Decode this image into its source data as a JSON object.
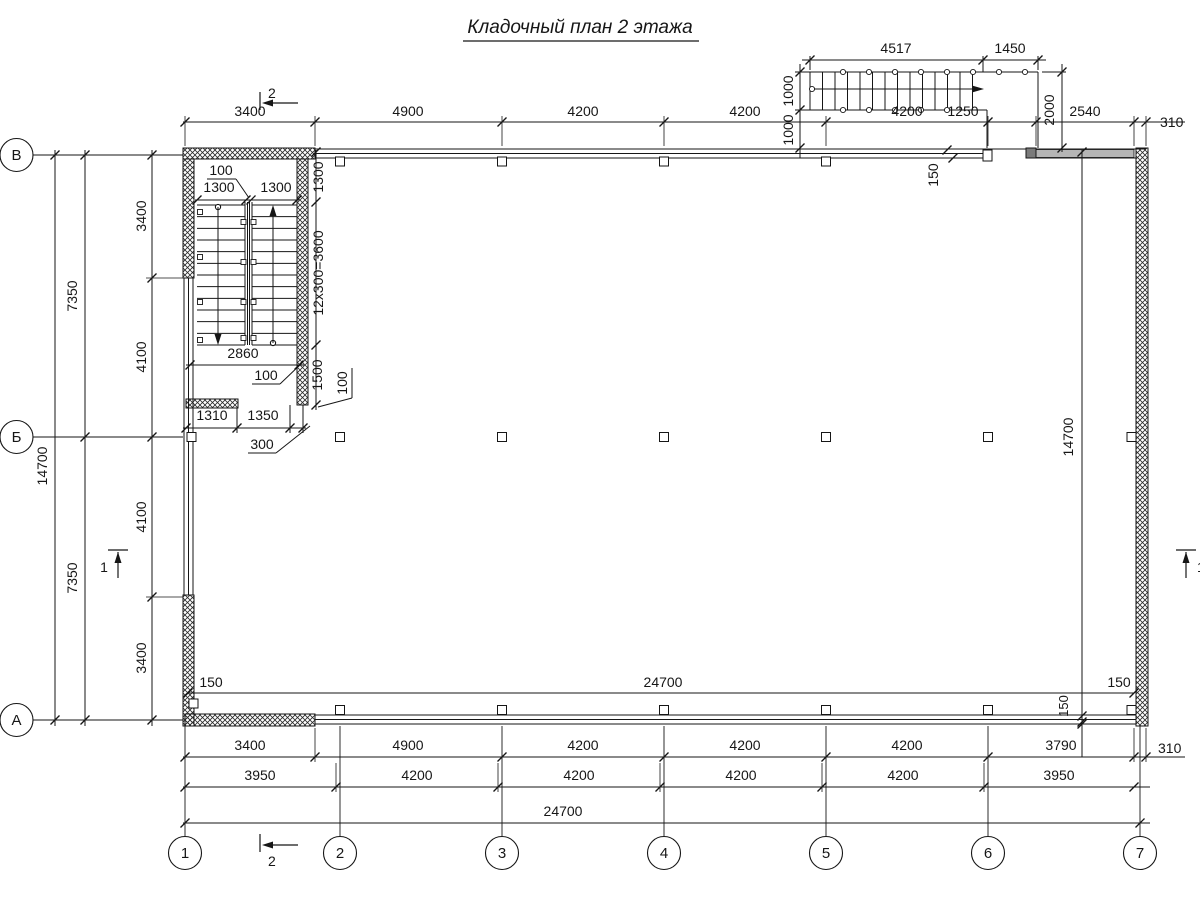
{
  "title": "Кладочный план 2 этажа",
  "axis_rows": [
    "В",
    "Б",
    "А"
  ],
  "axis_cols": [
    "1",
    "2",
    "3",
    "4",
    "5",
    "6",
    "7"
  ],
  "section_markers": {
    "top": "2",
    "bottom": "2",
    "left": "1",
    "right": "1"
  },
  "dims": {
    "top_row": [
      "3400",
      "4900",
      "4200",
      "4200",
      "4200",
      "1250",
      "2540",
      "310"
    ],
    "ext_stair_top": [
      "4517",
      "1450"
    ],
    "ext_stair_left": [
      "1000",
      "1000"
    ],
    "ext_stair_right": "2000",
    "wall_150_top": "150",
    "left_outer": "14700",
    "left_7350": [
      "7350",
      "7350"
    ],
    "left_inner": [
      "3400",
      "4100",
      "4100",
      "3400"
    ],
    "right_inner": "14700",
    "right_150": "150",
    "inner_bottom": [
      "150",
      "24700",
      "150"
    ],
    "bottom_row1": [
      "3400",
      "4900",
      "4200",
      "4200",
      "4200",
      "3790",
      "310"
    ],
    "bottom_row2": [
      "3950",
      "4200",
      "4200",
      "4200",
      "4200",
      "3950"
    ],
    "bottom_total": "24700",
    "stair_100_top": "100",
    "stair_1300_pair": [
      "1300",
      "1300"
    ],
    "stair_1300_v": "1300",
    "stair_run": "12x300=3600",
    "stair_2860": "2860",
    "stair_100_mid": "100",
    "stair_1500": "1500",
    "stair_100_right": "100",
    "stair_1310": "1310",
    "stair_1350": "1350",
    "stair_300": "300"
  }
}
